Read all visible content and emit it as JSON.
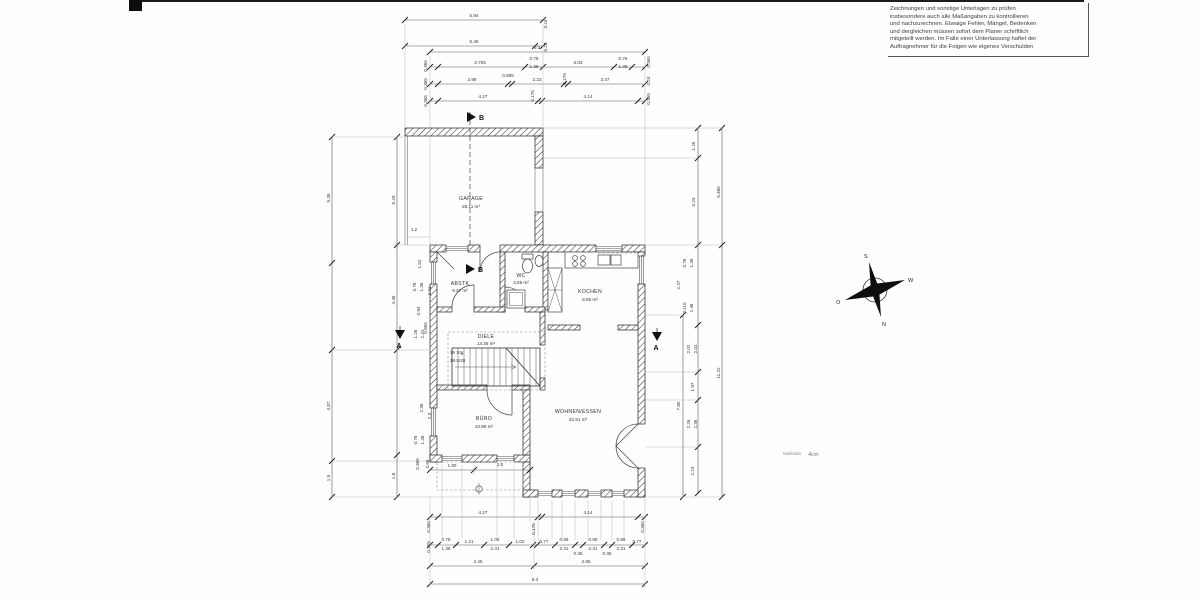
{
  "note": {
    "lines": [
      "Zeichnungen und sonstige Unterlagen zu prüfen",
      "insbesondere auch alle Maßangaben zu kontrollieren",
      "und nachzurechnen. Etwaige Fehler, Mängel, Bedenken",
      "und dergleichen müssen sofort dem Planer schriftlich",
      "mitgeteilt werden. Im Falle einer Unterlassung haftet der",
      "Auftragnehmer für die Folgen wie eigenes Verschulden"
    ]
  },
  "rooms": {
    "garage": {
      "name": "GARAGE",
      "area": "28.11 m²"
    },
    "abstk": {
      "name": "ABSTK",
      "area": "8.37 m²"
    },
    "wc": {
      "name": "WC",
      "area": "3.55 m²"
    },
    "kochen": {
      "name": "KOCHEN",
      "area": "8.85 m²"
    },
    "diele": {
      "name": "DIELE",
      "area": "14.36 m²"
    },
    "buero": {
      "name": "BÜRO",
      "area": "10.99 m²"
    },
    "wohnen": {
      "name": "WOHNEN/ESSEN",
      "area": "32.91 m²"
    }
  },
  "stair": {
    "line1": "15 Stg.",
    "line2": "18.5/28"
  },
  "sections": {
    "a": "A",
    "b": "B"
  },
  "compass": {
    "n": "N",
    "s": "S",
    "e": "O",
    "w": "W"
  },
  "scale_note": {
    "label": "Maßstab",
    "value": "4cm"
  },
  "dimensions": {
    "labels": [
      {
        "t": "5.94",
        "x": 474,
        "y": 17
      },
      {
        "t": "5.46",
        "x": 474,
        "y": 43
      },
      {
        "t": "0.24",
        "x": 547,
        "y": 24,
        "r": -90
      },
      {
        "t": "0.24",
        "x": 547,
        "y": 47,
        "r": -90
      },
      {
        "t": "9.3",
        "x": 537,
        "y": 49
      },
      {
        "t": "3.755",
        "x": 480,
        "y": 64
      },
      {
        "t": "0.76",
        "x": 534,
        "y": 60
      },
      {
        "t": "1.38",
        "x": 534,
        "y": 68
      },
      {
        "t": "3.03",
        "x": 578,
        "y": 64
      },
      {
        "t": "0.76",
        "x": 623,
        "y": 60
      },
      {
        "t": "1.38",
        "x": 623,
        "y": 68
      },
      {
        "t": "0.365",
        "x": 427,
        "y": 66,
        "r": -90
      },
      {
        "t": "0.365",
        "x": 650,
        "y": 62,
        "r": -90
      },
      {
        "t": "0.365",
        "x": 427,
        "y": 84,
        "r": -90
      },
      {
        "t": "2.98",
        "x": 472,
        "y": 81
      },
      {
        "t": "0.885",
        "x": 508,
        "y": 77
      },
      {
        "t": "2.23",
        "x": 537,
        "y": 81
      },
      {
        "t": "0.175",
        "x": 566,
        "y": 79,
        "r": -90
      },
      {
        "t": "3.47",
        "x": 605,
        "y": 81
      },
      {
        "t": "0.24",
        "x": 650,
        "y": 81,
        "r": -90
      },
      {
        "t": "0.365",
        "x": 427,
        "y": 101,
        "r": -90
      },
      {
        "t": "4.27",
        "x": 483,
        "y": 98
      },
      {
        "t": "0.175",
        "x": 534,
        "y": 96,
        "r": -90
      },
      {
        "t": "4.14",
        "x": 588,
        "y": 98
      },
      {
        "t": "0.365",
        "x": 650,
        "y": 99,
        "r": -90
      },
      {
        "t": "5.39",
        "x": 330,
        "y": 198,
        "r": -90
      },
      {
        "t": "4.87",
        "x": 330,
        "y": 406,
        "r": -90
      },
      {
        "t": "1.9",
        "x": 330,
        "y": 478,
        "r": -90
      },
      {
        "t": "5.29",
        "x": 395,
        "y": 200,
        "r": -90
      },
      {
        "t": "4.46",
        "x": 395,
        "y": 300,
        "r": -90
      },
      {
        "t": "1.8",
        "x": 395,
        "y": 476,
        "r": -90
      },
      {
        "t": "1.2",
        "x": 414,
        "y": 231
      },
      {
        "t": "1.52",
        "x": 421,
        "y": 264,
        "r": -90
      },
      {
        "t": "0.76",
        "x": 416,
        "y": 287,
        "r": -90
      },
      {
        "t": "1.38",
        "x": 423,
        "y": 287,
        "r": -90
      },
      {
        "t": "2.41",
        "x": 431,
        "y": 291,
        "r": -90
      },
      {
        "t": "0.94",
        "x": 420,
        "y": 311,
        "r": -90
      },
      {
        "t": "0.865",
        "x": 427,
        "y": 328,
        "r": -90
      },
      {
        "t": "1.26",
        "x": 417,
        "y": 334,
        "r": -90
      },
      {
        "t": "2.31",
        "x": 424,
        "y": 334,
        "r": -90
      },
      {
        "t": "2.36",
        "x": 423,
        "y": 408,
        "r": -90
      },
      {
        "t": "2.3",
        "x": 431,
        "y": 416,
        "r": -90
      },
      {
        "t": "0.76",
        "x": 417,
        "y": 440,
        "r": -90
      },
      {
        "t": "1.38",
        "x": 424,
        "y": 440,
        "r": -90
      },
      {
        "t": "0.365",
        "x": 419,
        "y": 464,
        "r": -90
      },
      {
        "t": "0.86",
        "x": 429,
        "y": 464,
        "r": -90
      },
      {
        "t": "1.25",
        "x": 695,
        "y": 146,
        "r": -90
      },
      {
        "t": "5.23",
        "x": 695,
        "y": 202,
        "r": -90
      },
      {
        "t": "5.485",
        "x": 720,
        "y": 192,
        "r": -90
      },
      {
        "t": "11.22",
        "x": 720,
        "y": 373,
        "r": -90
      },
      {
        "t": "7.80",
        "x": 680,
        "y": 406,
        "r": -90
      },
      {
        "t": "0.76",
        "x": 686,
        "y": 263,
        "r": -90
      },
      {
        "t": "1.38",
        "x": 693,
        "y": 263,
        "r": -90
      },
      {
        "t": "2.47",
        "x": 680,
        "y": 285,
        "r": -90
      },
      {
        "t": "0.115",
        "x": 686,
        "y": 308,
        "r": -90
      },
      {
        "t": "2.48",
        "x": 693,
        "y": 308,
        "r": -90
      },
      {
        "t": "2.02",
        "x": 690,
        "y": 349,
        "r": -90
      },
      {
        "t": "2.31",
        "x": 697,
        "y": 349,
        "r": -90
      },
      {
        "t": "1.97",
        "x": 694,
        "y": 387,
        "r": -90
      },
      {
        "t": "2.26",
        "x": 690,
        "y": 424,
        "r": -90
      },
      {
        "t": "2.36",
        "x": 697,
        "y": 424,
        "r": -90
      },
      {
        "t": "2.24",
        "x": 694,
        "y": 471,
        "r": -90
      },
      {
        "t": "4.27",
        "x": 483,
        "y": 514
      },
      {
        "t": "4.14",
        "x": 588,
        "y": 514
      },
      {
        "t": "0.175",
        "x": 535,
        "y": 529,
        "r": -90
      },
      {
        "t": "0.365",
        "x": 430,
        "y": 527,
        "r": -90
      },
      {
        "t": "0.365",
        "x": 644,
        "y": 527,
        "r": -90
      },
      {
        "t": "0.76",
        "x": 446,
        "y": 541
      },
      {
        "t": "1.38",
        "x": 446,
        "y": 550
      },
      {
        "t": "1.21",
        "x": 469,
        "y": 543
      },
      {
        "t": "1.06",
        "x": 495,
        "y": 541
      },
      {
        "t": "2.31",
        "x": 495,
        "y": 550
      },
      {
        "t": "1.03",
        "x": 520,
        "y": 543
      },
      {
        "t": "0.77",
        "x": 544,
        "y": 543
      },
      {
        "t": "0.86",
        "x": 564,
        "y": 541
      },
      {
        "t": "2.31",
        "x": 564,
        "y": 550
      },
      {
        "t": "0.36",
        "x": 578,
        "y": 555
      },
      {
        "t": "0.89",
        "x": 593,
        "y": 541
      },
      {
        "t": "2.31",
        "x": 593,
        "y": 550
      },
      {
        "t": "0.36",
        "x": 607,
        "y": 555
      },
      {
        "t": "0.86",
        "x": 621,
        "y": 541
      },
      {
        "t": "2.31",
        "x": 621,
        "y": 550
      },
      {
        "t": "0.77",
        "x": 637,
        "y": 543
      },
      {
        "t": "0.365",
        "x": 430,
        "y": 547,
        "r": -90
      },
      {
        "t": "4.45",
        "x": 478,
        "y": 563
      },
      {
        "t": "4.85",
        "x": 586,
        "y": 563
      },
      {
        "t": "9.3",
        "x": 535,
        "y": 581
      },
      {
        "t": "1.90",
        "x": 452,
        "y": 467
      },
      {
        "t": "2.5",
        "x": 500,
        "y": 466
      }
    ]
  }
}
